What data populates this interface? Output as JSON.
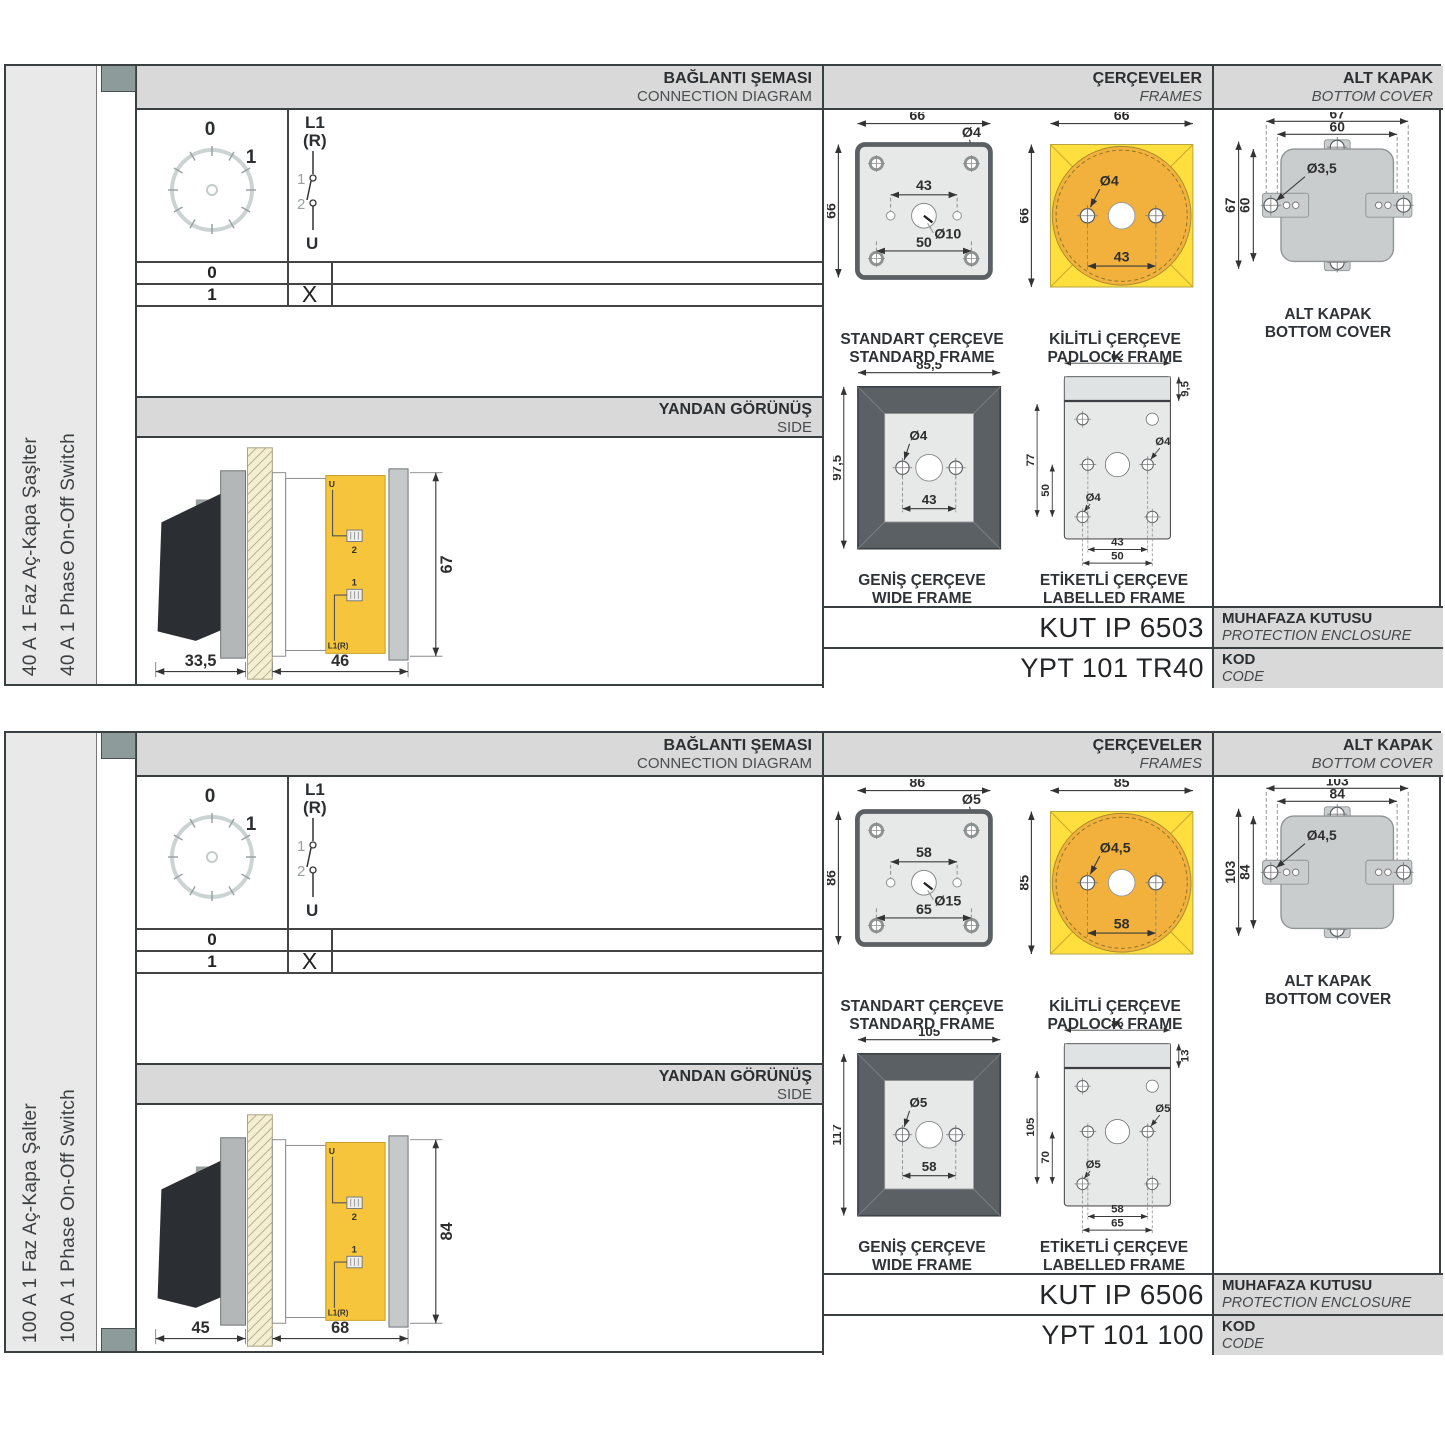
{
  "colors": {
    "hdr": "#d9d9d9",
    "lbl": "#e9e9e9",
    "dark": "#3a3f42",
    "mark": "#8e9b9b",
    "frameyellow": "#ffdf3e",
    "circleorange": "#f1b13c",
    "bodyyellow": "#f6c53b",
    "framedark": "#5a6064",
    "panel": "#e7e9e9",
    "cover": "#c9cdcd",
    "cream": "#f4efd2",
    "handle": "#2b2f33",
    "dim": "#2e2e2e"
  },
  "sections": [
    {
      "side_label_tr": "40 A 1 Faz Aç-Kapa Şaşlter",
      "side_label_en": "40 A 1 Phase On-Off Switch",
      "headers": {
        "connection_tr": "BAĞLANTI ŞEMASI",
        "connection_en": "CONNECTION DIAGRAM",
        "frames_tr": "ÇERÇEVELER",
        "frames_en": "FRAMES",
        "cover_tr": "ALT KAPAK",
        "cover_en": "BOTTOM COVER"
      },
      "dial": {
        "pos0": "0",
        "pos1": "1"
      },
      "schematic": {
        "top": "L1",
        "top2": "(R)",
        "c1": "1",
        "c2": "2",
        "bottom": "U"
      },
      "table": {
        "row0_label": "0",
        "row0_mark": "",
        "row1_label": "1",
        "row1_mark": "X"
      },
      "side_view": {
        "title_tr": "YANDAN GÖRÜNÜŞ",
        "title_en": "SIDE",
        "dim_handle": "33,5",
        "dim_depth": "46",
        "dim_height": "67",
        "t_u": "U",
        "t_1": "1",
        "t_2": "2",
        "t_l1r": "L1(R)"
      },
      "frames": {
        "standard": {
          "label_tr": "STANDART ÇERÇEVE",
          "label_en": "STANDARD FRAME",
          "dim_w": "66",
          "dim_h": "66",
          "hole": "Ø4",
          "span_top": "43",
          "center": "Ø10",
          "span_bottom": "50"
        },
        "padlock": {
          "label_tr": "KİLİTLİ ÇERÇEVE",
          "label_en": "PADLOCK FRAME",
          "dim_w": "66",
          "dim_h": "66",
          "hole": "Ø4",
          "span": "43"
        },
        "wide": {
          "label_tr": "GENİŞ ÇERÇEVE",
          "label_en": "WIDE FRAME",
          "dim_w": "85,5",
          "dim_h": "97,5",
          "hole": "Ø4",
          "span": "43"
        },
        "labelled": {
          "label_tr": "ETİKETLİ ÇERÇEVE",
          "label_en": "LABELLED FRAME",
          "dim_w": "62",
          "strip": "9,5",
          "dim_h": "77",
          "inner_h": "50",
          "hole1": "Ø4",
          "hole2": "Ø4",
          "span1": "43",
          "span2": "50"
        }
      },
      "cover": {
        "label_tr": "ALT KAPAK",
        "label_en": "BOTTOM COVER",
        "dim_w1": "67",
        "dim_w2": "60",
        "dim_h1": "67",
        "dim_h2": "60",
        "hole": "Ø3,5"
      },
      "enclosure": {
        "code": "KUT IP 6503",
        "label_tr": "MUHAFAZA KUTUSU",
        "label_en": "PROTECTION ENCLOSURE"
      },
      "code": {
        "value": "YPT 101 TR40",
        "label_tr": "KOD",
        "label_en": "CODE"
      }
    },
    {
      "side_label_tr": "100 A 1 Faz Aç-Kapa Şalter",
      "side_label_en": "100 A 1 Phase On-Off Switch",
      "headers": {
        "connection_tr": "BAĞLANTI ŞEMASI",
        "connection_en": "CONNECTION DIAGRAM",
        "frames_tr": "ÇERÇEVELER",
        "frames_en": "FRAMES",
        "cover_tr": "ALT KAPAK",
        "cover_en": "BOTTOM COVER"
      },
      "dial": {
        "pos0": "0",
        "pos1": "1"
      },
      "schematic": {
        "top": "L1",
        "top2": "(R)",
        "c1": "1",
        "c2": "2",
        "bottom": "U"
      },
      "table": {
        "row0_label": "0",
        "row0_mark": "",
        "row1_label": "1",
        "row1_mark": "X"
      },
      "side_view": {
        "title_tr": "YANDAN GÖRÜNÜŞ",
        "title_en": "SIDE",
        "dim_handle": "45",
        "dim_depth": "68",
        "dim_height": "84",
        "t_u": "U",
        "t_1": "1",
        "t_2": "2",
        "t_l1r": "L1(R)"
      },
      "frames": {
        "standard": {
          "label_tr": "STANDART ÇERÇEVE",
          "label_en": "STANDARD FRAME",
          "dim_w": "86",
          "dim_h": "86",
          "hole": "Ø5",
          "span_top": "58",
          "center": "Ø15",
          "span_bottom": "65"
        },
        "padlock": {
          "label_tr": "KİLİTLİ ÇERÇEVE",
          "label_en": "PADLOCK FRAME",
          "dim_w": "85",
          "dim_h": "85",
          "hole": "Ø4,5",
          "span": "58"
        },
        "wide": {
          "label_tr": "GENİŞ ÇERÇEVE",
          "label_en": "WIDE FRAME",
          "dim_w": "105",
          "dim_h": "117",
          "hole": "Ø5",
          "span": "58"
        },
        "labelled": {
          "label_tr": "ETİKETLİ ÇERÇEVE",
          "label_en": "LABELLED FRAME",
          "dim_w": "86",
          "strip": "13",
          "dim_h": "105",
          "inner_h": "70",
          "hole1": "Ø5",
          "hole2": "Ø5",
          "span1": "58",
          "span2": "65"
        }
      },
      "cover": {
        "label_tr": "ALT KAPAK",
        "label_en": "BOTTOM COVER",
        "dim_w1": "103",
        "dim_w2": "84",
        "dim_h1": "103",
        "dim_h2": "84",
        "hole": "Ø4,5"
      },
      "enclosure": {
        "code": "KUT IP 6506",
        "label_tr": "MUHAFAZA KUTUSU",
        "label_en": "PROTECTION ENCLOSURE"
      },
      "code": {
        "value": "YPT 101 100",
        "label_tr": "KOD",
        "label_en": "CODE"
      }
    }
  ]
}
